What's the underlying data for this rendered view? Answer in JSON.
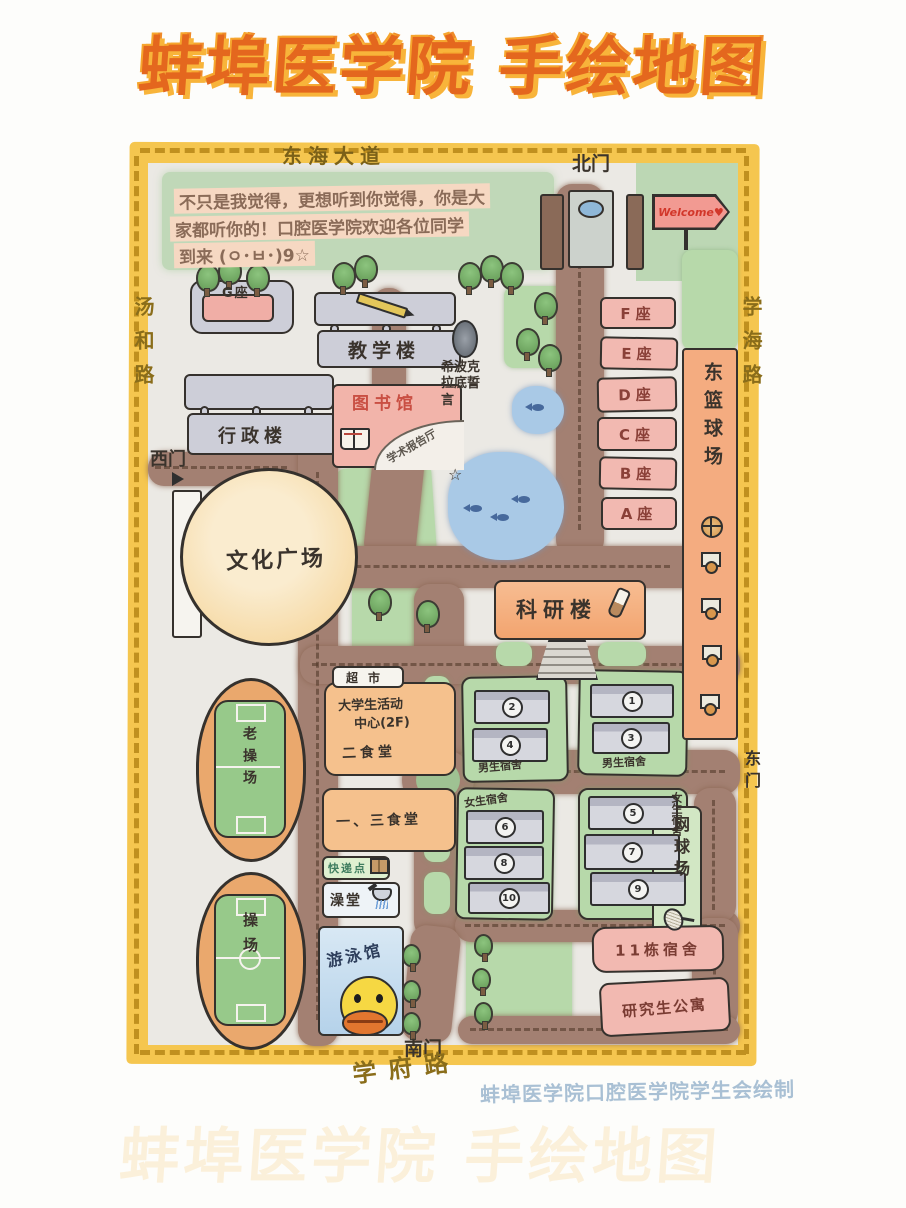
{
  "title": "蚌埠医学院 手绘地图",
  "attribution": "蚌埠医学院口腔医学院学生会绘制",
  "welcome_sign": "Welcome♥",
  "note": {
    "line1": "不只是我觉得，更想听到你觉得，你是大",
    "line2": "家都听你的！口腔医学院欢迎各位同学",
    "line3": "到来 (ㅇ･ㅂ･)9☆"
  },
  "border_roads": {
    "top": "东海大道",
    "left": "汤和路",
    "right": "学海路",
    "bottom": "学府路"
  },
  "gates": {
    "north": "北门",
    "west": "西门",
    "east": "东门",
    "south": "南门"
  },
  "campus": {
    "g_block": "G座",
    "teaching_building": "教学楼",
    "admin_building": "行政楼",
    "library": "图书馆",
    "lecture_hall": "学术报告厅",
    "hippocratic_oath": "希波克拉底誓言",
    "oath_star": "☆",
    "unit_blocks": [
      "F座",
      "E座",
      "D座",
      "C座",
      "B座",
      "A座"
    ],
    "east_basketball_court": "东篮球场",
    "culture_square": "文化广场",
    "research_building": "科研楼",
    "old_playground": "老操场",
    "playground": "操场",
    "supermarket": "超市",
    "activity_center_line1": "大学生活动",
    "activity_center_line2": "中心(2F)",
    "canteen_2": "二食堂",
    "canteen_1_3": "一、三食堂",
    "express_point": "快递点",
    "bathhouse": "澡堂",
    "swimming_pool": "游泳馆",
    "tennis_court": "网球场",
    "dorm_11": "11栋宿舍",
    "graduate_apartment": "研究生公寓",
    "boys_dorm_label": "男生宿舍",
    "girls_dorm_label": "女生宿舍",
    "dorm_numbers": {
      "b1": "1",
      "b2": "2",
      "b3": "3",
      "b4": "4",
      "b5": "5",
      "b6": "6",
      "b7": "7",
      "b8": "8",
      "b9": "9",
      "b10": "10"
    }
  },
  "colors": {
    "frame": "#f5c64f",
    "frame_dash": "#c0901f",
    "road": "#a38072",
    "lawn": "#b7d9aa",
    "pond": "#a9c9e6",
    "building_pink": "#f2b9b1",
    "building_grey": "#cdced8",
    "building_orange": "#f5c18d",
    "title_orange": "#e4671e",
    "title_shadow": "#f8b43a",
    "welcome_red": "#d2372a",
    "library_red": "#c94f43",
    "ink": "#33302e"
  }
}
